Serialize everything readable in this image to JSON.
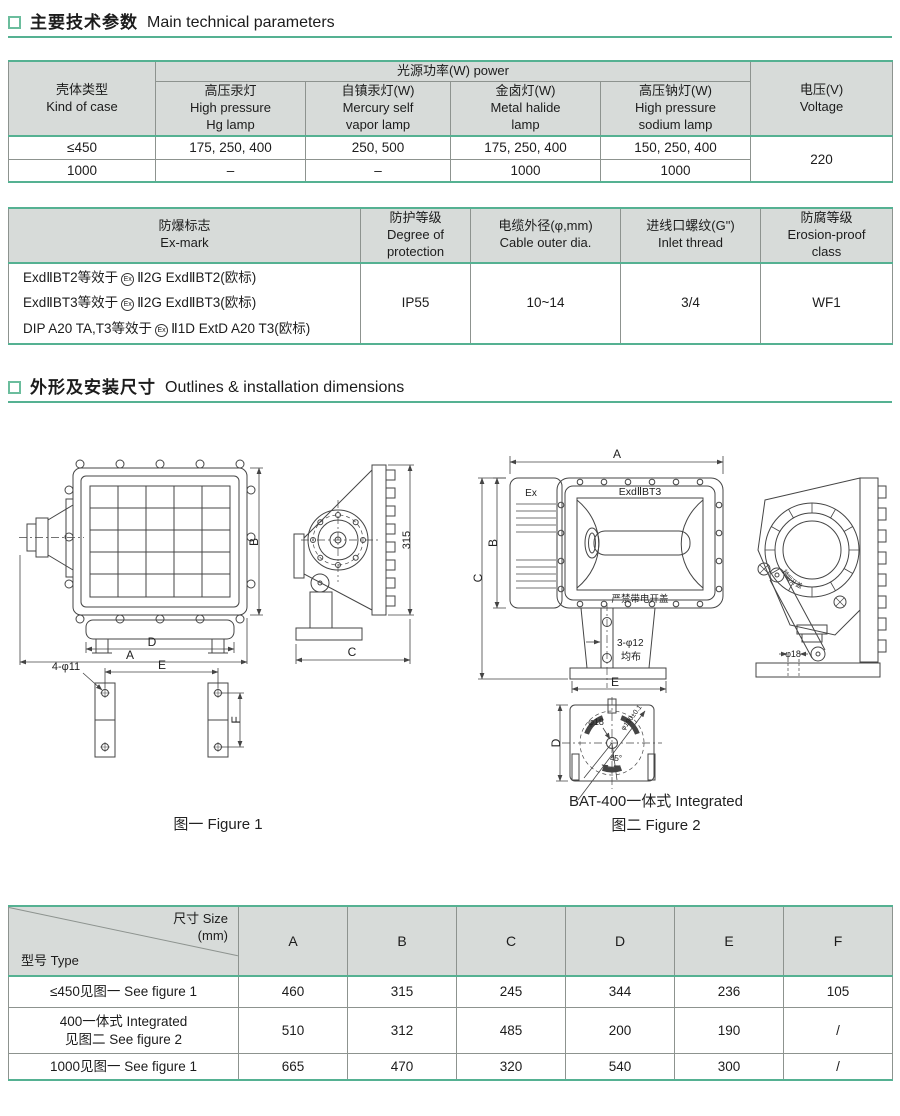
{
  "accent_color": "#55b192",
  "header_bg": "#d7dbd9",
  "section1": {
    "zh": "主要技术参数",
    "en": "Main technical parameters"
  },
  "section2": {
    "zh": "外形及安装尺寸",
    "en": "Outlines & installation dimensions"
  },
  "power_table": {
    "h_case": "壳体类型\nKind of case",
    "h_power": "光源功率(W) power",
    "h_hg": "高压汞灯\nHigh pressure\nHg lamp",
    "h_self": "自镇汞灯(W)\nMercury self\nvapor lamp",
    "h_halide": "金卤灯(W)\nMetal halide\nlamp",
    "h_sodium": "高压钠灯(W)\nHigh pressure\nsodium lamp",
    "h_voltage": "电压(V)\nVoltage",
    "rows": [
      {
        "case": "≤450",
        "hg": "175, 250, 400",
        "self": "250, 500",
        "halide": "175, 250, 400",
        "sodium": "150, 250, 400"
      },
      {
        "case": "1000",
        "hg": "–",
        "self": "–",
        "halide": "1000",
        "sodium": "1000"
      }
    ],
    "voltage": "220"
  },
  "ex_table": {
    "h_mark": "防爆标志\nEx-mark",
    "h_protection": "防护等级\nDegree of\nprotection",
    "h_cable": "电缆外径(φ,mm)\nCable outer dia.",
    "h_inlet": "进线口螺纹(G\")\nInlet  thread",
    "h_erosion": "防腐等级\nErosion-proof\nclass",
    "marks": [
      {
        "pre": "ExdⅡBT2等效于",
        "sym": "Ex",
        "post": "Ⅱ2G ExdⅡBT2(欧标)"
      },
      {
        "pre": "ExdⅡBT3等效于",
        "sym": "Ex",
        "post": "Ⅱ2G ExdⅡBT3(欧标)"
      },
      {
        "pre": "DIP A20 TA,T3等效于",
        "sym": "Ex",
        "post": "Ⅱ1D ExtD A20 T3(欧标)"
      }
    ],
    "protection": "IP55",
    "cable": "10~14",
    "inlet": "3/4",
    "erosion": "WF1"
  },
  "figures": {
    "fig1": {
      "caption": "图一 Figure 1",
      "dim_a": "A",
      "dim_b": "B",
      "dim_c": "C",
      "dim_d": "D",
      "dim_e": "E",
      "dim_f": "F",
      "dim_315": "315",
      "holes": "4-φ11"
    },
    "fig2": {
      "caption": "图二 Figure 2",
      "model": "BAT-400一体式 Integrated",
      "ex": "Ex",
      "mark": "ExdⅡBT3",
      "warning": "严禁带电开盖",
      "cover_note": "断电10分钟后开盖",
      "holes": "3-φ12",
      "holes_note": "均布",
      "dia_center": "φ18",
      "dia_base": "φ18",
      "bolt_circle": "φ190±0.1",
      "angle": "45°",
      "dim_a": "A",
      "dim_b": "B",
      "dim_c": "C",
      "dim_d": "D",
      "dim_e": "E"
    }
  },
  "size_table": {
    "corner_size": "尺寸 Size\n(mm)",
    "corner_type": "型号 Type",
    "cols": [
      "A",
      "B",
      "C",
      "D",
      "E",
      "F"
    ],
    "rows": [
      {
        "type": "≤450见图一  See figure 1",
        "v": [
          "460",
          "315",
          "245",
          "344",
          "236",
          "105"
        ]
      },
      {
        "type": "400一体式  Integrated\n见图二  See figure 2",
        "v": [
          "510",
          "312",
          "485",
          "200",
          "190",
          "/"
        ]
      },
      {
        "type": "1000见图一  See figure 1",
        "v": [
          "665",
          "470",
          "320",
          "540",
          "300",
          "/"
        ]
      }
    ]
  }
}
